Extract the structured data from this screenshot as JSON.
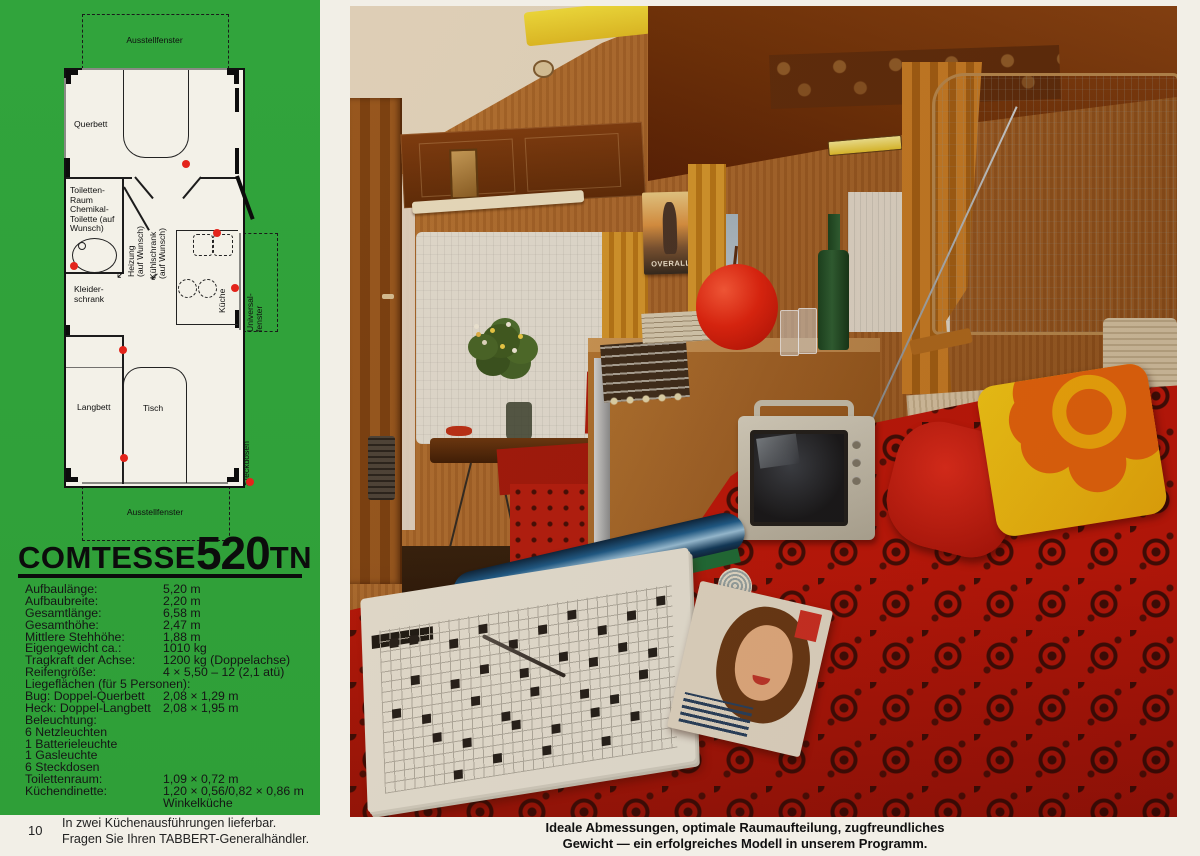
{
  "colors": {
    "green": "#31a43c",
    "paper": "#f2efe7",
    "red_fabric": "#c0170a",
    "accent_dot": "#e3241b",
    "wood": "#a9672c"
  },
  "floorplan": {
    "window_top": "Ausstellfenster",
    "window_bottom": "Ausstellfenster",
    "querbett": "Querbett",
    "toilette": "Toiletten-\nRaum\nChemikal-\nToilette (auf\nWunsch)",
    "kleiderschrank": "Kleider-\nschrank",
    "heizung": "Heizung\n(auf Wunsch)",
    "kuehlschrank": "Kühlschrank\n(auf Wunsch)",
    "kueche": "Küche",
    "universalfenster": "Universal-\nfenster",
    "langbett": "Langbett",
    "tisch": "Tisch",
    "steckdosen": "Steckdosen"
  },
  "title": {
    "brand": "COMTESSE",
    "model": "520",
    "suffix": "TN"
  },
  "specs": {
    "rows": [
      {
        "label": "Aufbaulänge:",
        "value": "5,20 m"
      },
      {
        "label": "Aufbaubreite:",
        "value": "2,20 m"
      },
      {
        "label": "Gesamtlänge:",
        "value": "6,58 m"
      },
      {
        "label": "Gesamthöhe:",
        "value": "2,47 m"
      },
      {
        "label": "Mittlere Stehhöhe:",
        "value": "1,88 m"
      },
      {
        "label": "Eigengewicht ca.:",
        "value": "1010 kg"
      },
      {
        "label": "Tragkraft der Achse:",
        "value": "1200 kg (Doppelachse)"
      },
      {
        "label": "Reifengröße:",
        "value": "4 × 5,50 – 12 (2,1 atü)"
      },
      {
        "label": "Liegeflächen (für 5 Personen):",
        "value": ""
      },
      {
        "label": "Bug: Doppel-Querbett",
        "value": "2,08 × 1,29 m"
      },
      {
        "label": "Heck: Doppel-Langbett",
        "value": "2,08 × 1,95 m"
      },
      {
        "label": "Beleuchtung:",
        "value": ""
      },
      {
        "label": "6 Netzleuchten",
        "value": ""
      },
      {
        "label": "1 Batterieleuchte",
        "value": ""
      },
      {
        "label": "1 Gasleuchte",
        "value": ""
      },
      {
        "label": "6 Steckdosen",
        "value": ""
      },
      {
        "label": "Toilettenraum:",
        "value": "1,09 × 0,72 m"
      },
      {
        "label": "Küchendinette:",
        "value": "1,20 × 0,56/0,82 × 0,86 m"
      },
      {
        "label": "",
        "value": "Winkelküche"
      }
    ]
  },
  "photo": {
    "poster_text": "OVERALL"
  },
  "caption": {
    "line1": "Ideale Abmessungen, optimale Raumaufteilung, zugfreundliches",
    "line2": "Gewicht — ein erfolgreiches Modell in unserem Programm."
  },
  "footer": {
    "page_number": "10",
    "line1": "In zwei Küchenausführungen lieferbar.",
    "line2": "Fragen Sie Ihren TABBERT-Generalhändler."
  }
}
